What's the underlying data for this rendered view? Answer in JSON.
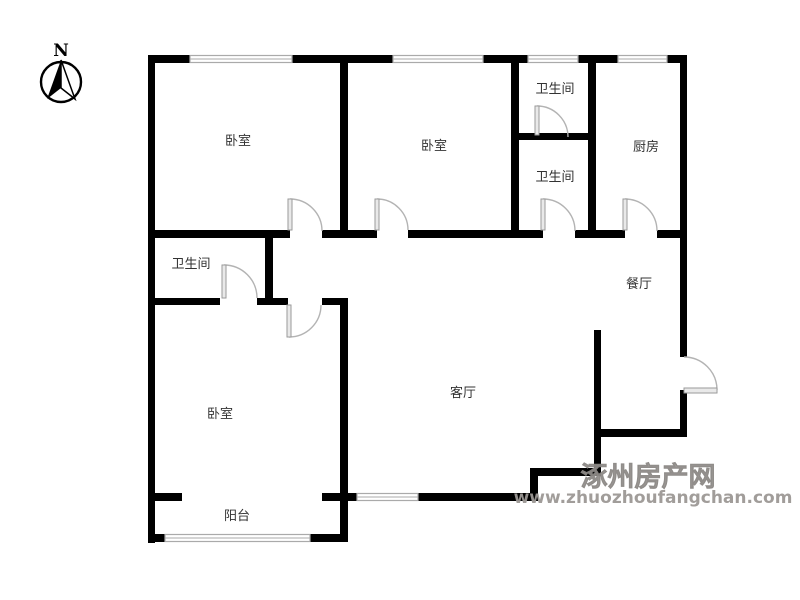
{
  "compass": {
    "label": "N"
  },
  "rooms": {
    "bedroom_top_left": {
      "label": "卧室"
    },
    "bedroom_top_middle": {
      "label": "卧室"
    },
    "bathroom_top_upper": {
      "label": "卫生间"
    },
    "bathroom_top_lower": {
      "label": "卫生间"
    },
    "kitchen": {
      "label": "厨房"
    },
    "dining": {
      "label": "餐厅"
    },
    "living": {
      "label": "客厅"
    },
    "bathroom_master": {
      "label": "卫生间"
    },
    "bedroom_master": {
      "label": "卧室"
    },
    "balcony": {
      "label": "阳台"
    }
  },
  "watermark": {
    "site_name": "涿州房产网",
    "site_url": "www.zhuozhoufangchan.com"
  },
  "colors": {
    "wall": "#000000",
    "door_arc": "#b3b3b3",
    "door_leaf_fill": "#e9e9e9",
    "window_line": "#aaaaaa",
    "label_text": "#333333",
    "watermark": "#9c9895"
  }
}
